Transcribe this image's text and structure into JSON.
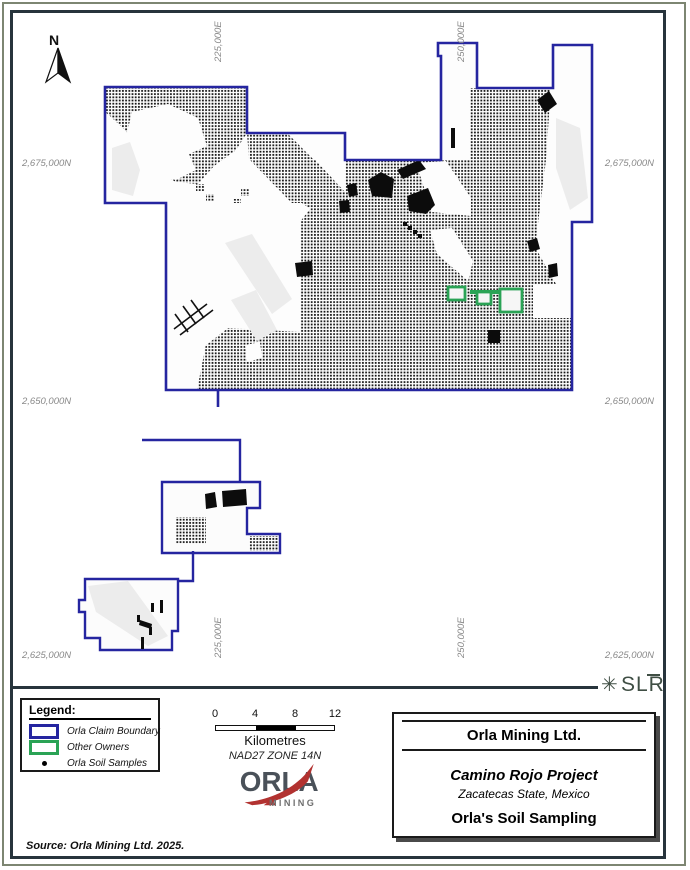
{
  "map": {
    "north_label": "N",
    "grid_labels": {
      "top": [
        "225,000E",
        "250,000E"
      ],
      "bottom": [
        "225,000E",
        "250,000E"
      ],
      "left": [
        "2,675,000N",
        "2,650,000N",
        "2,625,000N"
      ],
      "right": [
        "2,675,000N",
        "2,650,000N",
        "2,625,000N"
      ]
    }
  },
  "legend": {
    "title": "Legend:",
    "items": [
      {
        "swatch": "claim-boundary-swatch",
        "label": "Orla Claim Boundary"
      },
      {
        "swatch": "other-owners-swatch",
        "label": "Other Owners"
      },
      {
        "swatch": "soil-sample-dot",
        "label": "Orla Soil Samples"
      }
    ]
  },
  "scale_bar": {
    "ticks": [
      "0",
      "4",
      "8",
      "12"
    ],
    "unit_label": "Kilometres",
    "datum": "NAD27 ZONE 14N"
  },
  "logos": {
    "orla": {
      "wordmark": "ORLA",
      "subtext": "MINING"
    },
    "slr": {
      "text": "SLR"
    }
  },
  "title_block": {
    "company": "Orla Mining Ltd.",
    "project": "Camino Rojo Project",
    "location": "Zacatecas State, Mexico",
    "map_title": "Orla's Soil Sampling"
  },
  "source_note": "Source:  Orla Mining Ltd. 2025.",
  "colors": {
    "claim_boundary": "#2525a0",
    "other_owners": "#2aa355",
    "soil_sample": "#000000",
    "frame": "#27343c",
    "outer_frame": "#7d8672",
    "grid_label": "#898989",
    "orla_red": "#b23230",
    "orla_gray": "#4a5159",
    "slr_green": "#3f4e44"
  }
}
